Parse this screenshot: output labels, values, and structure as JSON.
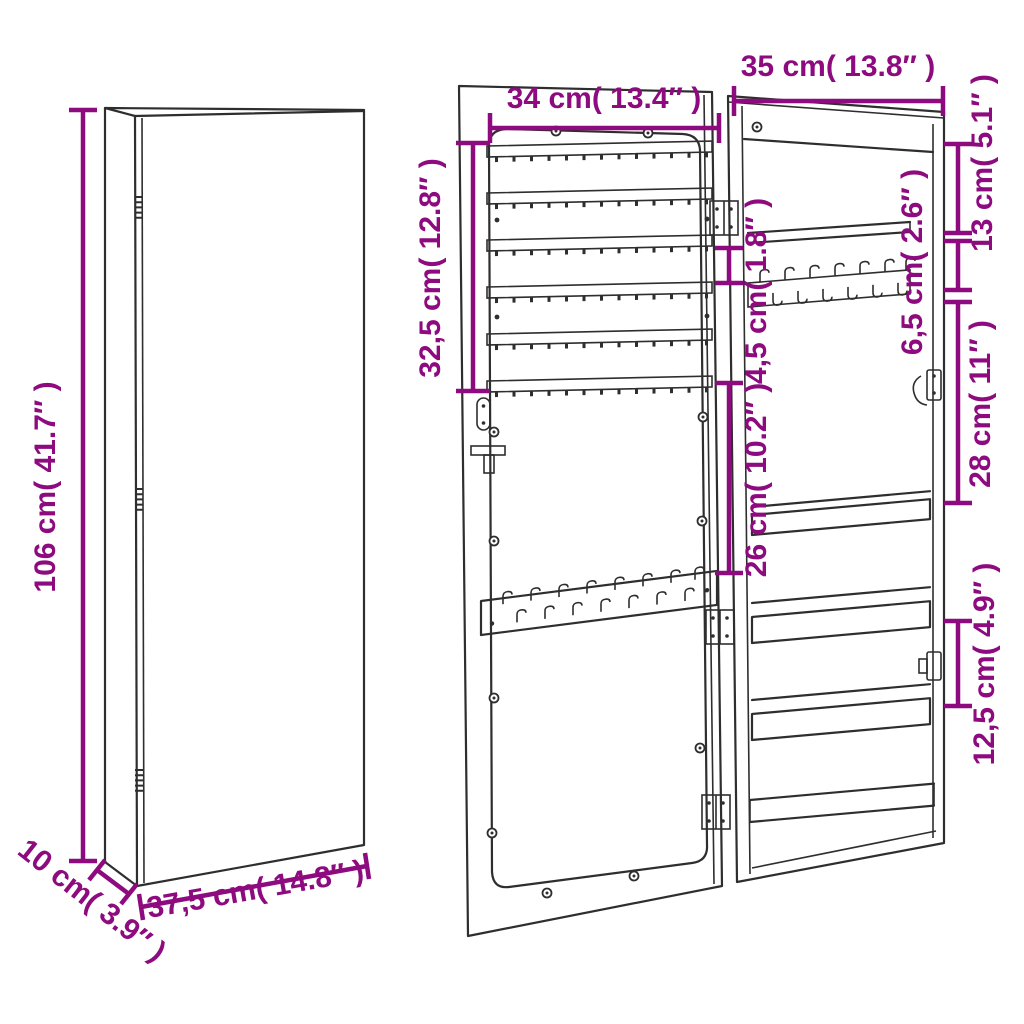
{
  "colors": {
    "dimension": "#8d0a7f",
    "lineart": "#2e2e2e",
    "background": "#ffffff"
  },
  "dimensions": {
    "closed_height": "106 cm( 41.7″ )",
    "closed_depth": "10 cm( 3.9″ )",
    "closed_width": "37,5 cm( 14.8″ )",
    "door_width": "34 cm( 13.4″ )",
    "body_width": "35 cm( 13.8″ )",
    "door_rack_height": "32,5 cm( 12.8″ )",
    "body_top_section": "13 cm( 5.1″ )",
    "body_shelf_gap_top": "6,5 cm( 2.6″ )",
    "door_gap": "4,5 cm( 1.8″ )",
    "door_lower_section": "26 cm( 10.2″ )",
    "body_middle_section": "28 cm( 11″ )",
    "body_shelf_gap_bottom": "12,5 cm( 4.9″ )"
  }
}
